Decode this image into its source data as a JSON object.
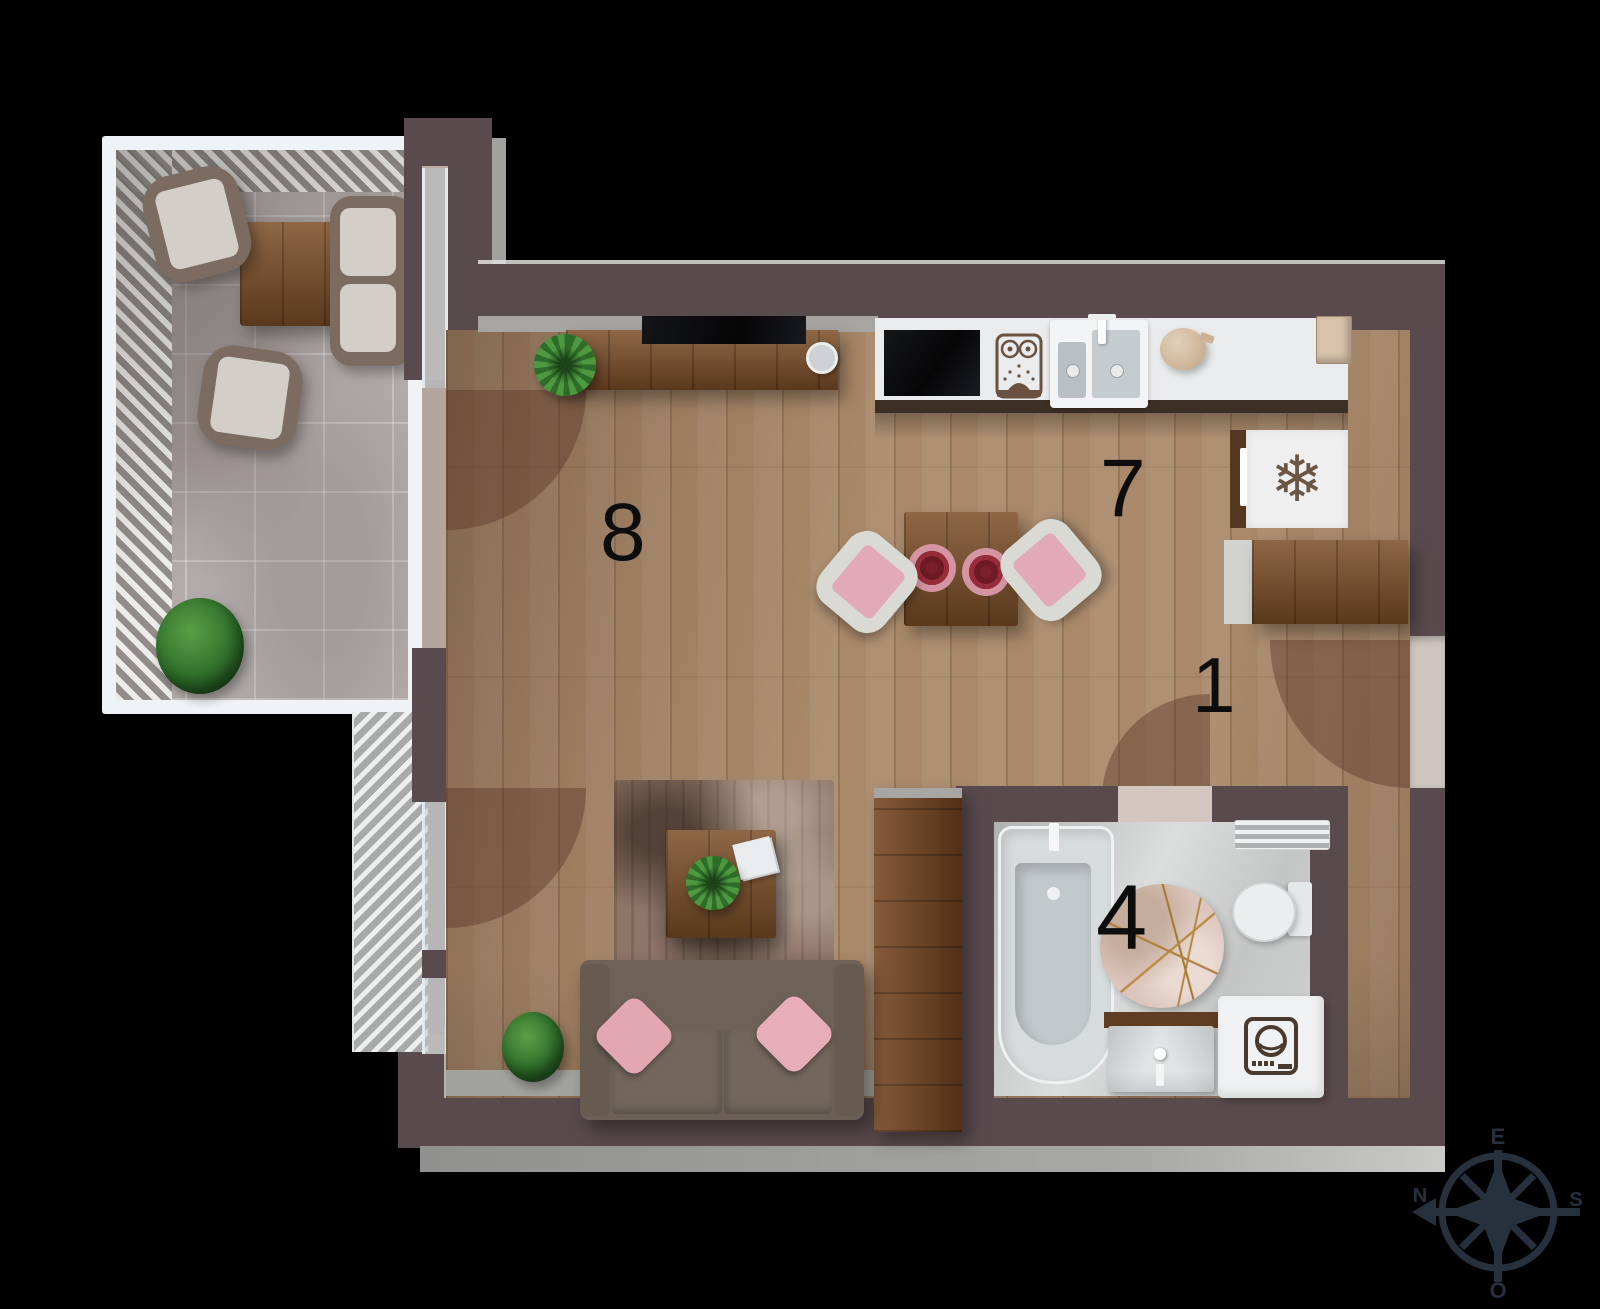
{
  "plan": {
    "rooms": {
      "living": {
        "number": "8"
      },
      "kitchen": {
        "number": "7"
      },
      "hall": {
        "number": "1"
      },
      "bathroom": {
        "number": "4"
      }
    },
    "compass": {
      "top": "E",
      "left": "N",
      "right": "S",
      "bottom": "O"
    },
    "icons": {
      "snowflake": "❄"
    },
    "colors": {
      "background": "#000000",
      "wall": "#594a4d",
      "shaft": "#4a3a39",
      "wood_floor": "#a9896a",
      "balcony_tile": "#b2abaa",
      "kitchen_counter": "#e9ebec",
      "bathroom_floor": "#c7cac9",
      "sofa": "#6b5f56",
      "pillow_pink": "#e3a8b4",
      "chair_pink": "#e2a9b7",
      "plant_green": "#35722e",
      "door_swing": "rgba(88,52,38,0.42)",
      "compass": "#27303d"
    }
  }
}
